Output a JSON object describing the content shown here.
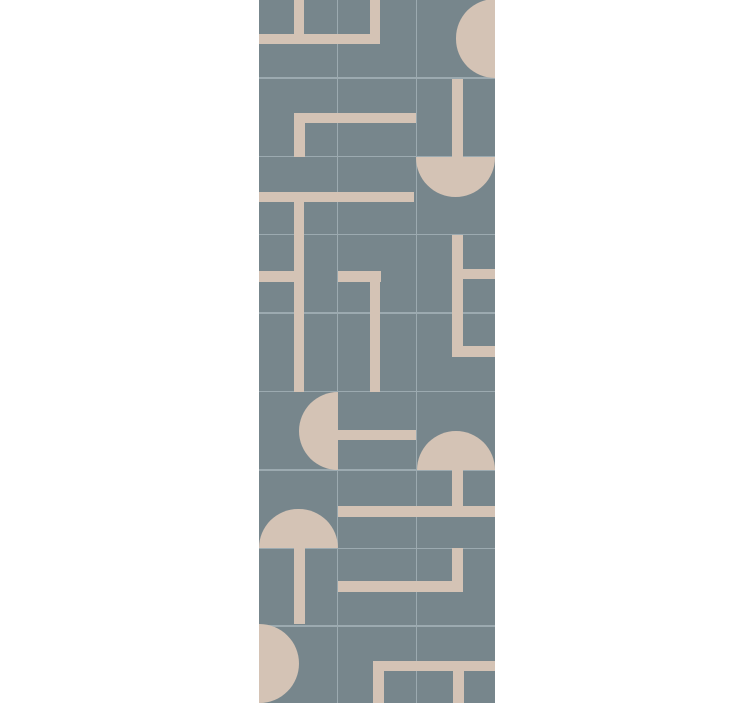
{
  "page": {
    "width": 752,
    "height": 703,
    "background_color": "#ffffff"
  },
  "rug": {
    "description": "geometric-runner-rug-pattern",
    "x": 259,
    "y": 0,
    "width": 236,
    "height": 703,
    "background_color": "#77868c",
    "shape_color": "#d4c3b5",
    "grid_color": "#9caab0",
    "grid_thickness": 1.6,
    "grid": {
      "vertical_lines_x": [
        78.7,
        157.3
      ],
      "horizontal_lines_y": [
        78.2,
        156.7,
        234.7,
        312.8,
        391.4,
        469.9,
        548.3,
        626.2
      ]
    },
    "shapes": [
      {
        "name": "top-staple-left-prong",
        "type": "rect",
        "x": 34.5,
        "y": 0,
        "w": 10.8,
        "h": 34
      },
      {
        "name": "top-staple-bar",
        "type": "rect",
        "x": 0,
        "y": 33.6,
        "w": 121.3,
        "h": 10.8
      },
      {
        "name": "top-staple-right-prong",
        "type": "rect",
        "x": 110.5,
        "y": 0,
        "w": 10.8,
        "h": 34
      },
      {
        "name": "half-disc-right-edge-top",
        "type": "circle",
        "half": "full",
        "cx": 236,
        "cy": 38.3,
        "r": 39.3
      },
      {
        "name": "vbar-right-row2",
        "type": "rect",
        "x": 192.8,
        "y": 78.8,
        "w": 11,
        "h": 78.2
      },
      {
        "name": "corner-bar-row2",
        "type": "rect",
        "x": 35,
        "y": 112.7,
        "w": 121.7,
        "h": 10.8
      },
      {
        "name": "corner-leg-row2",
        "type": "rect",
        "x": 35,
        "y": 123,
        "w": 10.8,
        "h": 34
      },
      {
        "name": "half-disc-down-row3",
        "type": "circle",
        "half": "bottom",
        "cx": 196.7,
        "cy": 157,
        "r": 39.5
      },
      {
        "name": "hbar-row3-left",
        "type": "rect",
        "x": 0,
        "y": 191.5,
        "w": 155,
        "h": 10.8
      },
      {
        "name": "vline-left-long",
        "type": "rect",
        "x": 34.5,
        "y": 202,
        "w": 10.8,
        "h": 189.6
      },
      {
        "name": "stub-left-edge-row4",
        "type": "rect",
        "x": 0,
        "y": 271.3,
        "w": 35.3,
        "h": 10.8
      },
      {
        "name": "corner-bar-mid-row4",
        "type": "rect",
        "x": 78.9,
        "y": 270.9,
        "w": 42.8,
        "h": 10.8
      },
      {
        "name": "corner-leg-mid-rows4-5",
        "type": "rect",
        "x": 110.7,
        "y": 281.4,
        "w": 10.8,
        "h": 110.2
      },
      {
        "name": "vbar-right-rows4-5",
        "type": "rect",
        "x": 193,
        "y": 234.9,
        "w": 11,
        "h": 122
      },
      {
        "name": "stub-right-edge-row4",
        "type": "rect",
        "x": 204,
        "y": 268.9,
        "w": 32,
        "h": 10.6
      },
      {
        "name": "lbar-right-row5",
        "type": "rect",
        "x": 193,
        "y": 346.2,
        "w": 43,
        "h": 10.8
      },
      {
        "name": "half-disc-left-facing-row6",
        "type": "circle",
        "half": "left",
        "cx": 78.7,
        "cy": 430.7,
        "r": 39.2
      },
      {
        "name": "key-bar-row6",
        "type": "rect",
        "x": 78.9,
        "y": 429.9,
        "w": 78.2,
        "h": 10.6
      },
      {
        "name": "half-disc-up-row6-right",
        "type": "circle",
        "half": "top",
        "cx": 196.7,
        "cy": 469.9,
        "r": 39
      },
      {
        "name": "stem-right-row7",
        "type": "rect",
        "x": 192.8,
        "y": 469.9,
        "w": 11,
        "h": 36.6
      },
      {
        "name": "hbar-row7",
        "type": "rect",
        "x": 78.7,
        "y": 505.9,
        "w": 157.3,
        "h": 10.8
      },
      {
        "name": "half-disc-up-row7-left",
        "type": "circle",
        "half": "top",
        "cx": 39.3,
        "cy": 548.3,
        "r": 39.3
      },
      {
        "name": "stem-left-row8",
        "type": "rect",
        "x": 35.2,
        "y": 548.3,
        "w": 11,
        "h": 76.2
      },
      {
        "name": "l-vert-right-row8",
        "type": "rect",
        "x": 192.8,
        "y": 548.3,
        "w": 11,
        "h": 43.2
      },
      {
        "name": "l-horiz-row8",
        "type": "rect",
        "x": 78.7,
        "y": 580.8,
        "w": 125.2,
        "h": 10.8
      },
      {
        "name": "half-disc-left-edge-row9",
        "type": "circle",
        "half": "full",
        "cx": 0,
        "cy": 663,
        "r": 39.5
      },
      {
        "name": "comb-bar-row9",
        "type": "rect",
        "x": 114.3,
        "y": 660.5,
        "w": 121.7,
        "h": 10.6
      },
      {
        "name": "comb-leg1-row9",
        "type": "rect",
        "x": 114.3,
        "y": 671,
        "w": 10.8,
        "h": 32
      },
      {
        "name": "comb-leg2-row9",
        "type": "rect",
        "x": 194.3,
        "y": 671,
        "w": 10.3,
        "h": 32
      }
    ]
  }
}
